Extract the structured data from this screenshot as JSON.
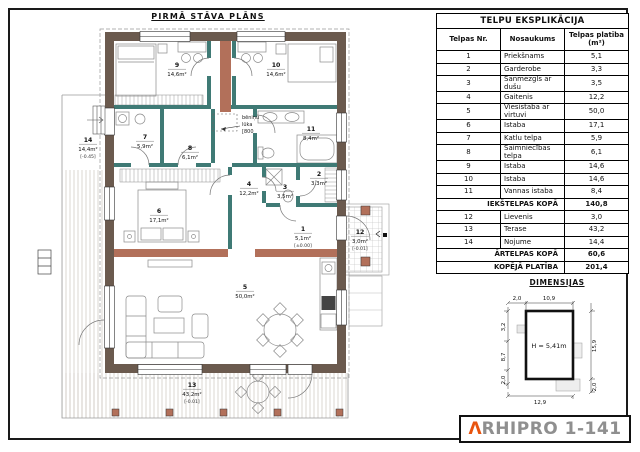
{
  "plan": {
    "title": "PIRMĀ STĀVA PLĀNS",
    "attic_note": [
      "bēniņu",
      "lūka",
      "[800"
    ],
    "rooms": [
      {
        "nr": "1",
        "area": "5,1m²",
        "elev": "[±0.00]"
      },
      {
        "nr": "2",
        "area": "3,3m²"
      },
      {
        "nr": "3",
        "area": "3,5m²"
      },
      {
        "nr": "4",
        "area": "12,2m²"
      },
      {
        "nr": "5",
        "area": "50,0m²"
      },
      {
        "nr": "6",
        "area": "17,1m²"
      },
      {
        "nr": "7",
        "area": "5,9m²"
      },
      {
        "nr": "8",
        "area": "6,1m²"
      },
      {
        "nr": "9",
        "area": "14,6m²"
      },
      {
        "nr": "10",
        "area": "14,6m²"
      },
      {
        "nr": "11",
        "area": "8,4m²"
      },
      {
        "nr": "12",
        "area": "3,0m²",
        "elev": "[-0.01]"
      },
      {
        "nr": "13",
        "area": "43,2m²",
        "elev": "[-0.01]"
      },
      {
        "nr": "14",
        "area": "14,4m²",
        "elev": "[-0.45]"
      }
    ],
    "colors": {
      "exterior_wall": "#6b5a4e",
      "interior_wall": "#3f7a75",
      "masonry_wall": "#b2705a"
    }
  },
  "table": {
    "title": "TELPU EKSPLIKĀCIJA",
    "columns": [
      "Telpas Nr.",
      "Nosaukums",
      "Telpas platība (m²)"
    ],
    "rows": [
      {
        "nr": "1",
        "name": "Priekšnams",
        "area": "5,1"
      },
      {
        "nr": "2",
        "name": "Garderobe",
        "area": "3,3"
      },
      {
        "nr": "3",
        "name": "Sanmezgls ar dušu",
        "area": "3,5"
      },
      {
        "nr": "4",
        "name": "Gaitenis",
        "area": "12,2"
      },
      {
        "nr": "5",
        "name": "Viesistaba ar virtuvi",
        "area": "50,0"
      },
      {
        "nr": "6",
        "name": "Istaba",
        "area": "17,1"
      },
      {
        "nr": "7",
        "name": "Katlu telpa",
        "area": "5,9"
      },
      {
        "nr": "8",
        "name": "Saimniecības telpa",
        "area": "6,1"
      },
      {
        "nr": "9",
        "name": "Istaba",
        "area": "14,6"
      },
      {
        "nr": "10",
        "name": "Istaba",
        "area": "14,6"
      },
      {
        "nr": "11",
        "name": "Vannas istaba",
        "area": "8,4"
      },
      {
        "type": "summary",
        "label": "IEKŠTELPAS KOPĀ",
        "area": "140,8"
      },
      {
        "nr": "12",
        "name": "Lievenis",
        "area": "3,0"
      },
      {
        "nr": "13",
        "name": "Terase",
        "area": "43,2"
      },
      {
        "nr": "14",
        "name": "Nojume",
        "area": "14,4"
      },
      {
        "type": "summary",
        "label": "ĀRTELPAS KOPĀ",
        "area": "60,6"
      },
      {
        "type": "total",
        "label": "KOPĒJĀ PLATĪBA",
        "area": "201,4"
      }
    ]
  },
  "dimensions": {
    "title": "DIMENSIJAS",
    "height_label": "H = 5,41m",
    "top": [
      "2,0",
      "10,9"
    ],
    "bottom": [
      "12,9"
    ],
    "left": [
      "3,2",
      "8,7",
      "2,0"
    ],
    "right": [
      "15,9",
      "2,0"
    ]
  },
  "logo": {
    "accent_letter": "Λ",
    "text": "RHIPRO 1-141",
    "accent_color": "#e8540f",
    "text_color": "#8f8f8f"
  }
}
